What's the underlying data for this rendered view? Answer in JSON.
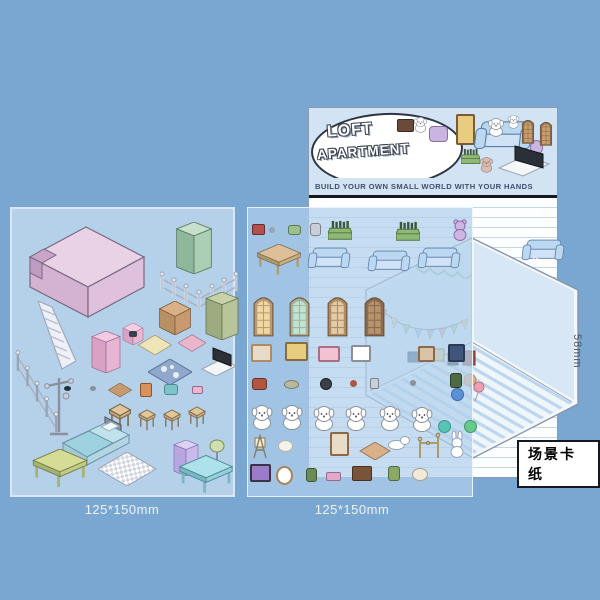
{
  "page": {
    "background_color": "#7aa6d2",
    "type": "product-photo-sticker-kit"
  },
  "notepad": {
    "title_line1": "LOFT",
    "title_line2": "APARTMENT",
    "tagline": "BUILD YOUR OWN SMALL WORLD WITH YOUR HANDS",
    "header_bg": "#d2e3f4",
    "line_color": "#c6d7e8",
    "header_stickers": [
      "shelf",
      "puppy",
      "armchair",
      "picture-frame",
      "sofa-with-puppy-and-bunny",
      "teddy-bear",
      "bottle-crate",
      "puppy-dog",
      "tv-on-stand",
      "arched-window",
      "arched-window"
    ],
    "body_stickers": [
      "sofa"
    ]
  },
  "left_sheet": {
    "caption": "125*150mm",
    "bg": "#b5d1e9",
    "stickers": [
      "loft-platform",
      "refrigerator",
      "garden-fence",
      "staircase",
      "storage-box",
      "wardrobe",
      "microwave",
      "sideboard-cabinet",
      "area-rug",
      "magazine-rack",
      "diagonal-fence",
      "spotted-rug",
      "laptop",
      "bead",
      "bead",
      "wall-shelf",
      "book",
      "toy-teal",
      "toy-pink",
      "floor-stand",
      "stool-large",
      "stool",
      "stool",
      "stool",
      "bed",
      "bench",
      "checkered-rug",
      "mini-fridge",
      "table-lamp",
      "coffee-table"
    ]
  },
  "middle_sheet": {
    "caption": "125*150mm",
    "bg": "rgba(176,208,236,0.72)",
    "stickers": [
      "camera",
      "bead",
      "watering-can",
      "jar",
      "bottle-crate",
      "bottle-crate",
      "teddy-bear",
      "wooden-table",
      "sofa",
      "sofa",
      "sofa",
      "arched-window-yellow",
      "arched-window-teal",
      "arched-window-tan",
      "arched-window-brown",
      "picture-frame-tan",
      "picture-frame-yellow",
      "picture-frame-pink",
      "picture-frame-dog",
      "picture-frame-small",
      "picture-frame-navy",
      "trumpet",
      "fish",
      "frying-pan",
      "berry",
      "jar-small",
      "plant-pot",
      "dot-blue",
      "dot-teal",
      "dot-green",
      "puppy",
      "puppy",
      "puppy",
      "puppy",
      "puppy",
      "puppy",
      "easel-chair",
      "egg",
      "mirror-frame",
      "wall-plank",
      "dishes",
      "coat-rack",
      "bunny",
      "picture-frame-purple",
      "wall-clock",
      "potted-plant",
      "book-pink",
      "toy-truck",
      "flower-pot",
      "pumpkin"
    ]
  },
  "scene_card": {
    "label": "场景卡纸",
    "height_label": "58mm",
    "edge_label_fragment": "mm",
    "decorations": [
      "bunting-garland",
      "scallop-garland",
      "picture-frames",
      "balloons",
      "striped-floor"
    ]
  },
  "colors": {
    "background": "#7aa6d2",
    "sheet_blue": "#b5d1e9",
    "loft_pink": "#e7cfe4",
    "fridge_green": "#abcfb4",
    "sofa_blue": "#bcd7f0",
    "card_wall": "#d9e9f8",
    "card_floor_stripe": "#bdd6ee",
    "rule_black": "#15181e",
    "bunting": [
      "#f2a6b8",
      "#f5d98a",
      "#a8d8a0",
      "#a9c8ef",
      "#cdb6e3"
    ]
  }
}
